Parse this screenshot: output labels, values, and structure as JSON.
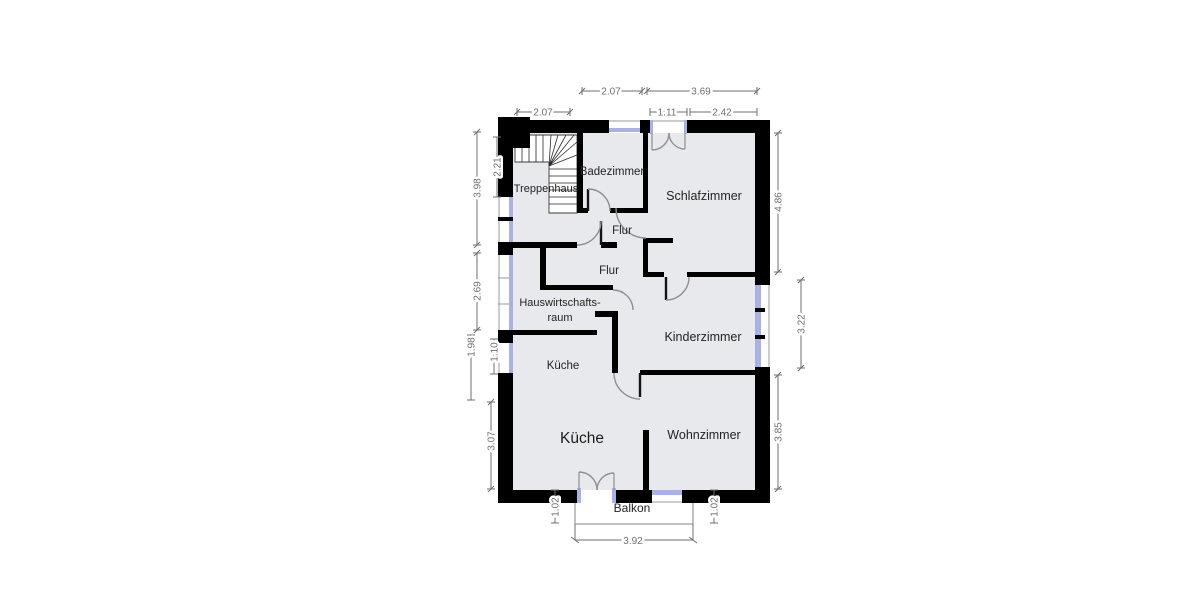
{
  "rooms": {
    "treppenhaus": "Treppenhaus",
    "badezimmer": "Badezimmer",
    "schlafzimmer": "Schlafzimmer",
    "flur_upper": "Flur",
    "flur_lower": "Flur",
    "hauswirtschaftsraum_line1": "Hauswirtschafts-",
    "hauswirtschaftsraum_line2": "raum",
    "kueche_upper": "Küche",
    "kueche_main": "Küche",
    "kinderzimmer": "Kinderzimmer",
    "wohnzimmer": "Wohnzimmer",
    "balkon": "Balkon"
  },
  "dims": {
    "top_treppenhaus": "2.07",
    "top_badezimmer": "2.07",
    "top_schlafzimmer_total": "3.69",
    "top_schlafzimmer_door": "1.11",
    "top_schlafzimmer_wall": "2.42",
    "left_treppenhaus_outer": "3.98",
    "left_treppenhaus_inner": "2.21",
    "left_hauswirtschaftsraum": "2.69",
    "left_kueche_upper": "1.98",
    "left_kueche_window": "1.10",
    "left_kueche_lower": "3.07",
    "right_schlafzimmer": "4.86",
    "right_kinderzimmer": "3.22",
    "right_wohnzimmer": "3.85",
    "balkon_depth_left": "1.02",
    "balkon_depth_right": "1.02",
    "balkon_width": "3.92"
  },
  "colors": {
    "wall": "#000000",
    "floor": "#e8e9ec",
    "window": "#aab1e4",
    "dimension": "#6f6f6f",
    "door_arc": "#8f8f8f"
  }
}
